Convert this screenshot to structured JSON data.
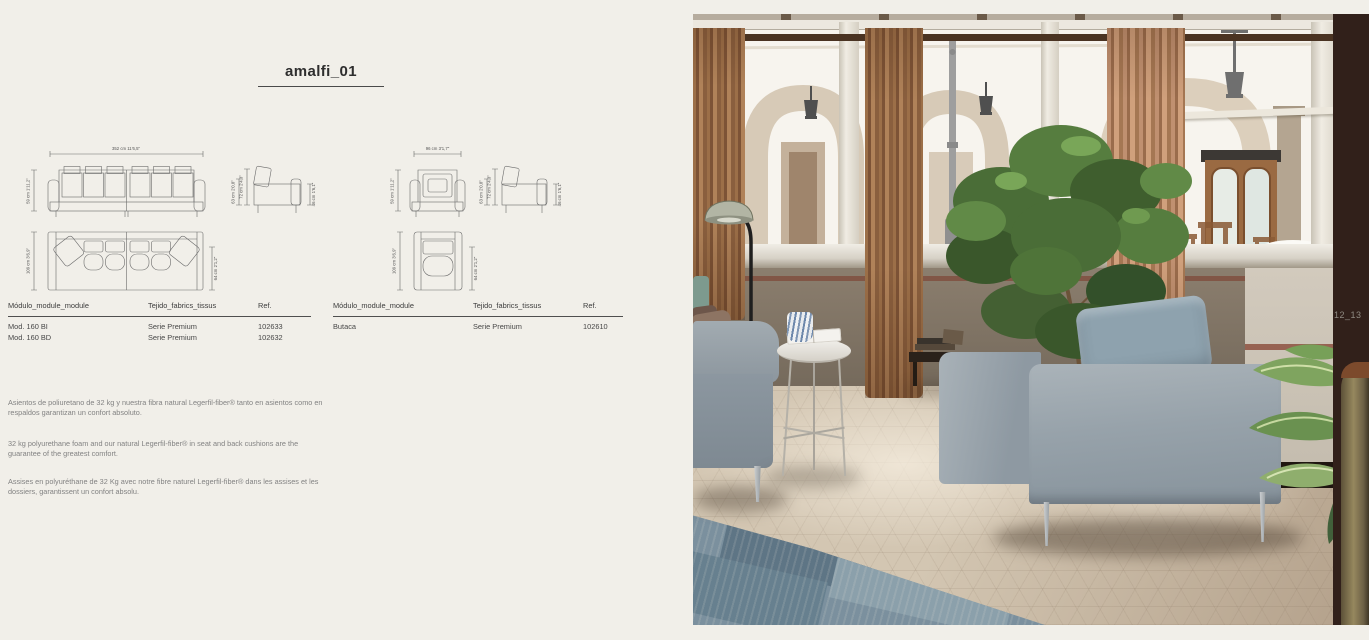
{
  "page": {
    "title": "amalfi_01",
    "background": "#f1efe9"
  },
  "drawings": {
    "sofa": {
      "width_label": "352 cm 11'6,5\"",
      "height_label": "59 cm 1'11,2\"",
      "arm_height_label": "63 cm 2'0,8\"",
      "total_height_label": "72 cm 2'4,3\"",
      "seat_height_label": "46 cm 1'6,1\"",
      "depth_label": "109 cm 3'6,9\"",
      "seat_depth_label": "64 cm 2'1,2\""
    },
    "armchair": {
      "width_label": "96 cm 3'1,7\"",
      "height_label": "59 cm 1'11,2\"",
      "arm_height_label": "63 cm 2'0,8\"",
      "total_height_label": "72 cm 2'4,3\"",
      "seat_height_label": "46 cm 1'6,1\"",
      "depth_label": "109 cm 3'6,9\"",
      "seat_depth_label": "64 cm 2'1,2\""
    }
  },
  "tables": {
    "columns": [
      "Módulo_module_module",
      "Tejido_fabrics_tissus",
      "Ref."
    ],
    "left": {
      "rows": [
        {
          "module": "Mod. 160 BI",
          "fabric": "Serie Premium",
          "ref": "102633"
        },
        {
          "module": "Mod. 160 BD",
          "fabric": "Serie Premium",
          "ref": "102632"
        }
      ]
    },
    "right": {
      "rows": [
        {
          "module": "Butaca",
          "fabric": "Serie Premium",
          "ref": "102610"
        }
      ]
    }
  },
  "descriptions": {
    "es": "Asientos de poliuretano de 32 kg y nuestra fibra natural Legerfil-fiber® tanto en asientos como en respaldos garantizan un confort absoluto.",
    "en": "32 kg polyurethane foam and our natural Legerfil-fiber® in seat and back cushions are the guarantee of the greatest comfort.",
    "fr": "Assises en polyuréthane de 32 Kg avec notre fibre naturel Legerfil-fiber® dans les assises et les dossiers, garantissent un confort absolu.",
    "foot_note": ""
  },
  "photo": {
    "page_marker": "12_13",
    "colors": {
      "curtain": "#a87a52",
      "armchair_fabric": "#96a2aa",
      "plant_green": "#4a6d37",
      "rug_blue": "#7e93a1",
      "floor": "#cfc2ae",
      "wood_column": "#31201a",
      "wall": "#8a7c6b"
    }
  }
}
